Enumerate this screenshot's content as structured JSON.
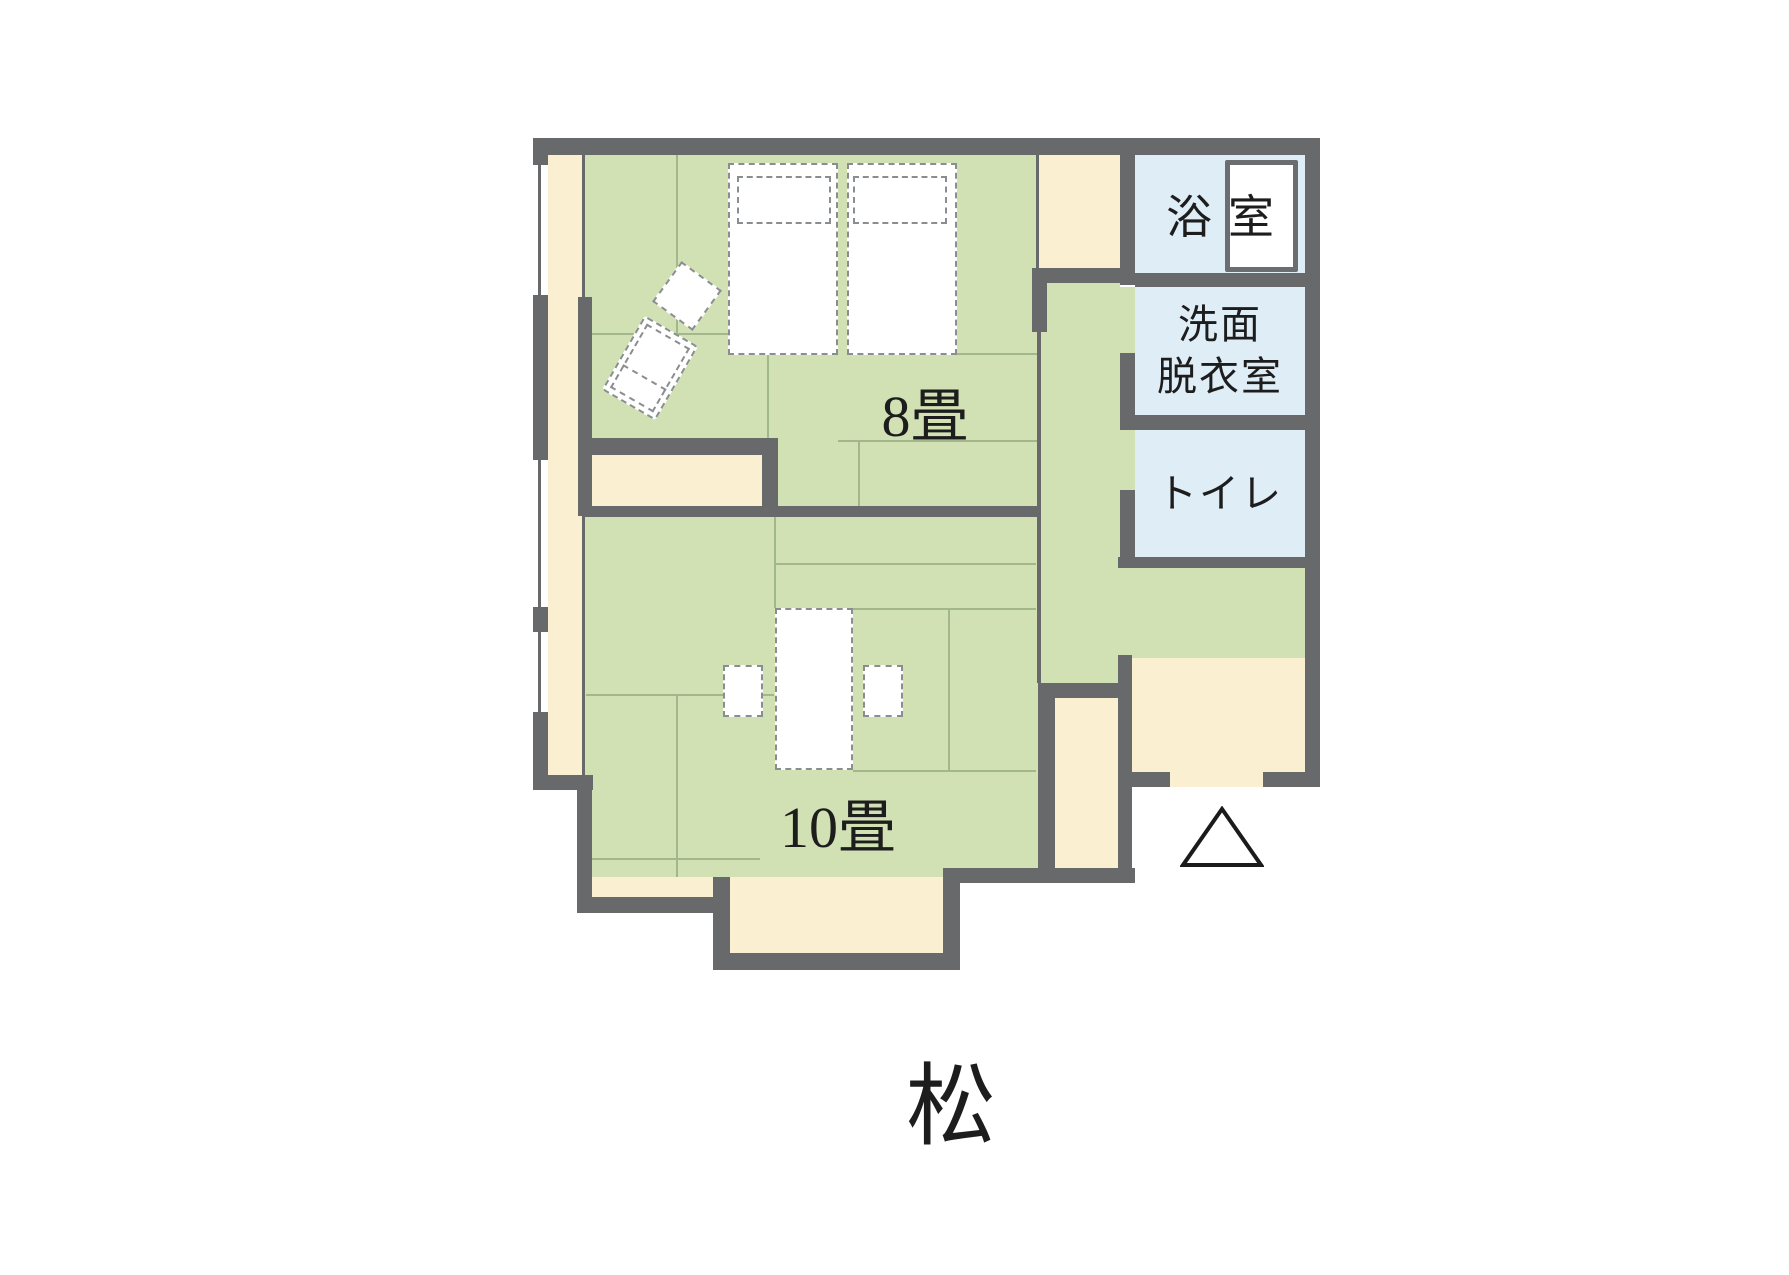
{
  "title": "松",
  "rooms": {
    "room8": {
      "label": "8畳"
    },
    "room10": {
      "label": "10畳"
    },
    "bath": {
      "label": "浴室"
    },
    "washroom": {
      "line1": "洗面",
      "line2": "脱衣室"
    },
    "toilet": {
      "label": "トイレ"
    }
  },
  "icons": {
    "entrance_marker": "triangle-outline-entrance-mark"
  },
  "colors": {
    "wall": "#67696b",
    "tatami": "#d1e1b4",
    "tatamiLine": "#a2b78b",
    "wood": "#fbefd2",
    "wet": "#dfedf6",
    "dash": "#8b8e90",
    "ink": "#1d1d1d",
    "paper": "#ffffff",
    "tub": "#6b6e71"
  }
}
